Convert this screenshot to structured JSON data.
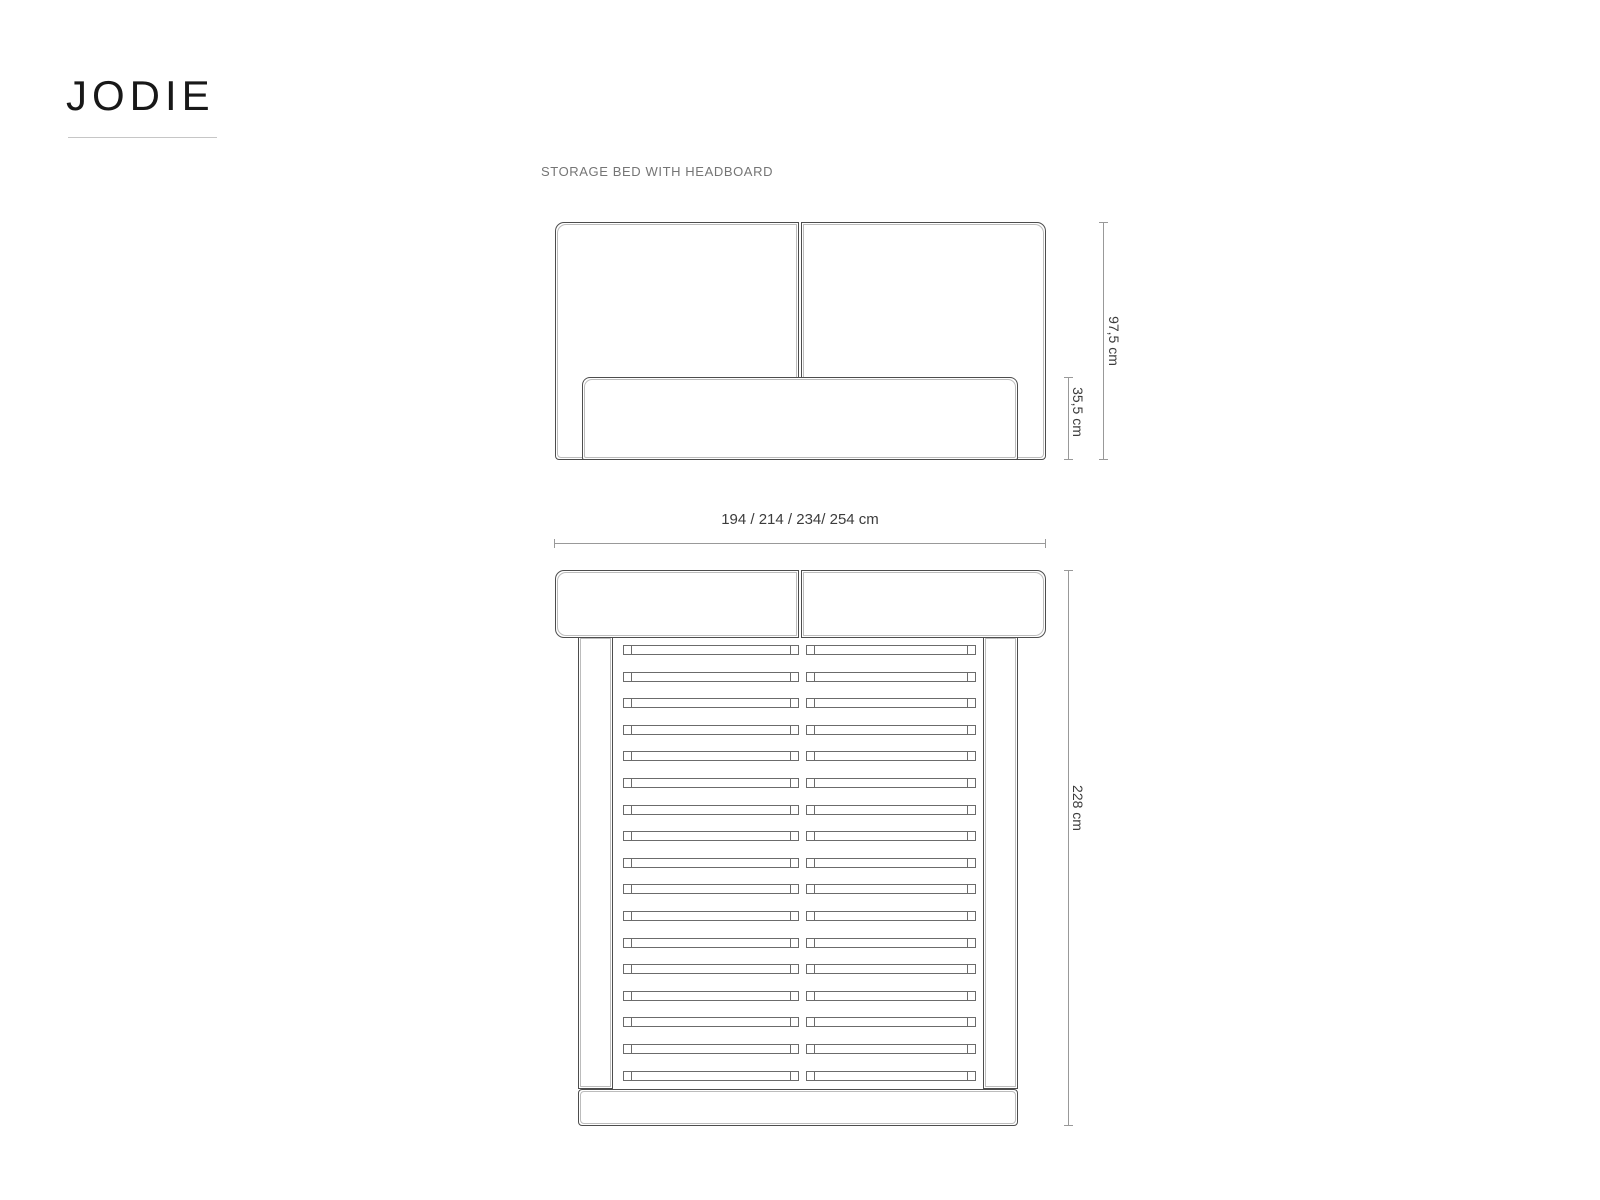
{
  "page": {
    "title": "JODIE",
    "subtitle": "STORAGE BED WITH HEADBOARD"
  },
  "colors": {
    "background": "#ffffff",
    "outline_dark": "#4d4d4d",
    "outline_inner": "#bcbcbc",
    "dimension_line": "#999999",
    "dimension_text": "#3c3c3c",
    "title_text": "#181818",
    "subtitle_text": "#757575"
  },
  "front_view": {
    "headboard_height_label": "97,5 cm",
    "frame_height_label": "35,5 cm"
  },
  "top_view": {
    "width_label": "194 / 214 / 234/ 254 cm",
    "length_label": "228 cm",
    "slat_rows": 17
  }
}
